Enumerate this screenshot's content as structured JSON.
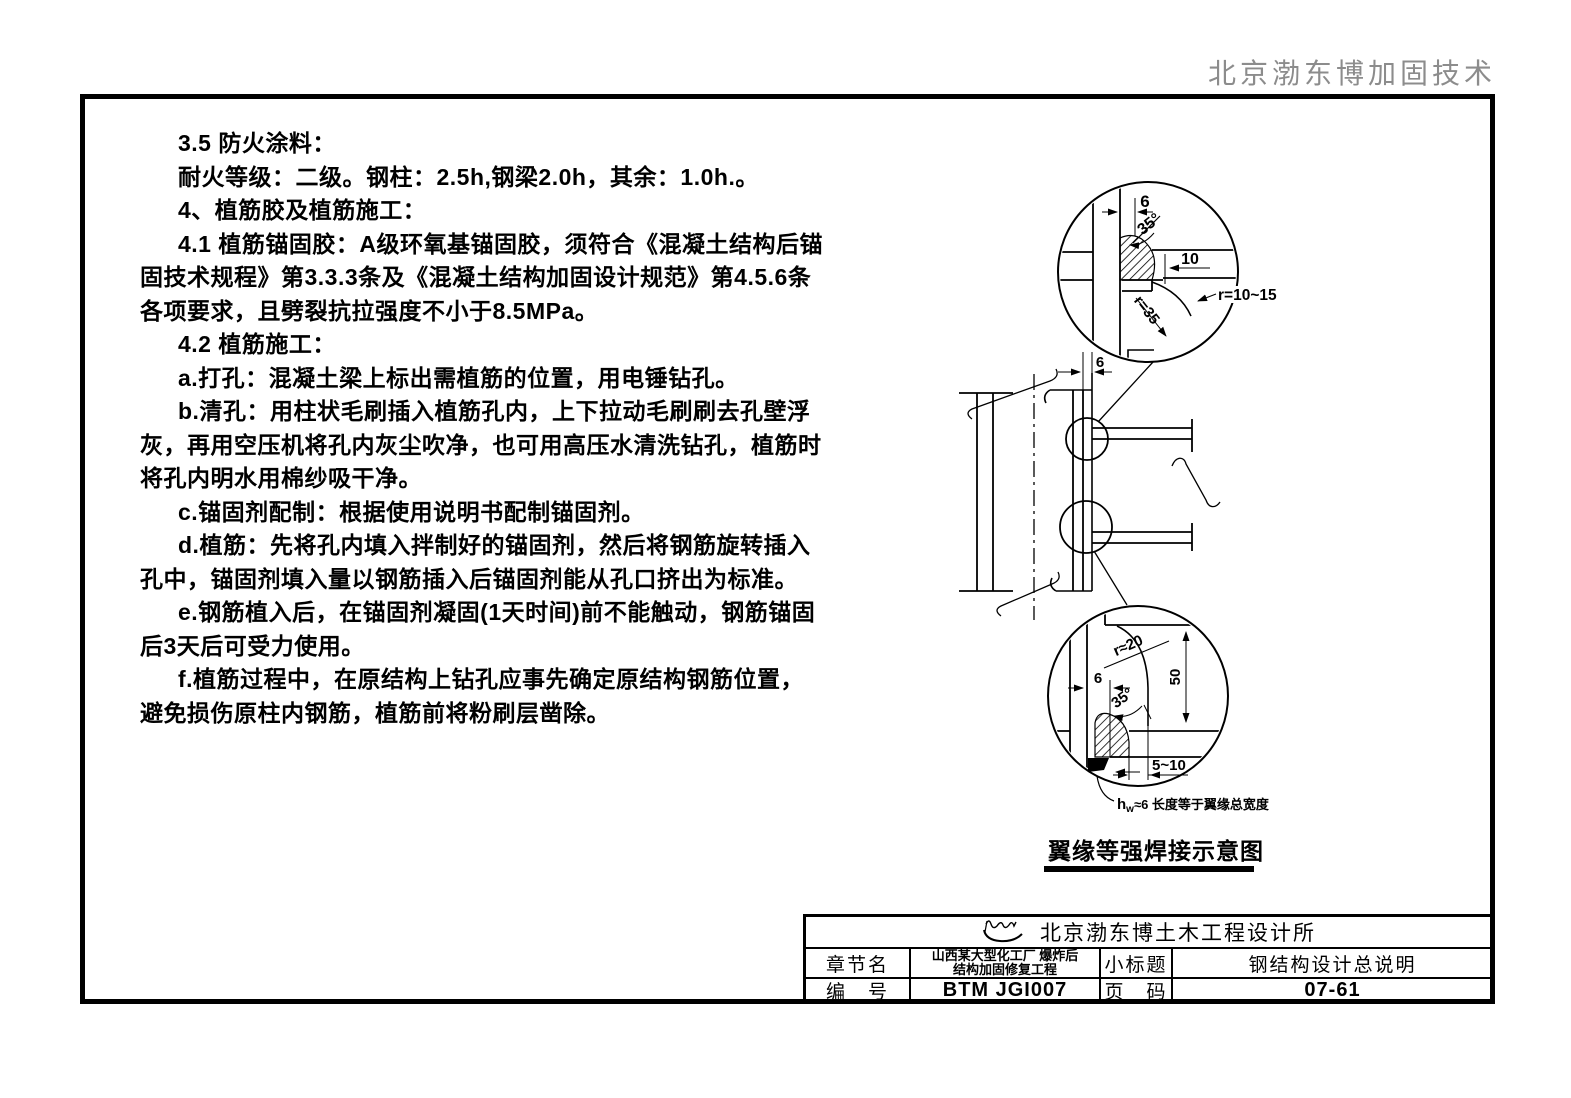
{
  "header": {
    "company_tag": "北京渤东博加固技术"
  },
  "notes": {
    "lines": [
      {
        "text": "3.5 防火涂料：",
        "indent": true
      },
      {
        "text": "耐火等级：二级。钢柱：2.5h,钢梁2.0h，其余：1.0h.。",
        "indent": true
      },
      {
        "text": "4、植筋胶及植筋施工：",
        "indent": true
      },
      {
        "text": "4.1 植筋锚固胶：A级环氧基锚固胶，须符合《混凝土结构后锚",
        "indent": true
      },
      {
        "text": "固技术规程》第3.3.3条及《混凝土结构加固设计规范》第4.5.6条",
        "indent": false
      },
      {
        "text": "各项要求，且劈裂抗拉强度不小于8.5MPa。",
        "indent": false
      },
      {
        "text": "4.2 植筋施工：",
        "indent": true
      },
      {
        "text": "a.打孔：混凝土梁上标出需植筋的位置，用电锤钻孔。",
        "indent": true
      },
      {
        "text": "b.清孔：用柱状毛刷插入植筋孔内，上下拉动毛刷刷去孔壁浮",
        "indent": true
      },
      {
        "text": "灰，再用空压机将孔内灰尘吹净，也可用高压水清洗钻孔，植筋时",
        "indent": false
      },
      {
        "text": "将孔内明水用棉纱吸干净。",
        "indent": false
      },
      {
        "text": "c.锚固剂配制：根据使用说明书配制锚固剂。",
        "indent": true
      },
      {
        "text": "d.植筋：先将孔内填入拌制好的锚固剂，然后将钢筋旋转插入",
        "indent": true
      },
      {
        "text": "孔中，锚固剂填入量以钢筋插入后锚固剂能从孔口挤出为标准。",
        "indent": false
      },
      {
        "text": "e.钢筋植入后，在锚固剂凝固(1天时间)前不能触动，钢筋锚固",
        "indent": true
      },
      {
        "text": "后3天后可受力使用。",
        "indent": false
      },
      {
        "text": "f.植筋过程中，在原结构上钻孔应事先确定原结构钢筋位置，",
        "indent": true
      },
      {
        "text": "避免损伤原柱内钢筋，植筋前将粉刷层凿除。",
        "indent": false
      }
    ]
  },
  "diagram": {
    "caption": "翼缘等强焊接示意图",
    "labels": {
      "top_gap": "6",
      "top_angle": "35°",
      "top_backing": "10",
      "top_radius_web": "r=35",
      "top_radius_note": "r=10~15",
      "mid_gap": "6",
      "bot_radius": "r≈20",
      "bot_height": "50",
      "bot_gap": "6",
      "bot_angle": "35°",
      "bot_backing": "5~10",
      "weld_note_h": "h",
      "weld_note_sub": "w",
      "weld_note_rest": "≈6 长度等于翼缘总宽度"
    }
  },
  "title_block": {
    "company": "北京渤东博土木工程设计所",
    "chapter_label": "章节名",
    "chapter_line1": "山西某大型化工厂 爆炸后",
    "chapter_line2": "结构加固修复工程",
    "subtitle_label": "小标题",
    "subtitle": "钢结构设计总说明",
    "number_label": "编　号",
    "number": "BTM JGI007",
    "page_label": "页　码",
    "page": "07-61"
  }
}
